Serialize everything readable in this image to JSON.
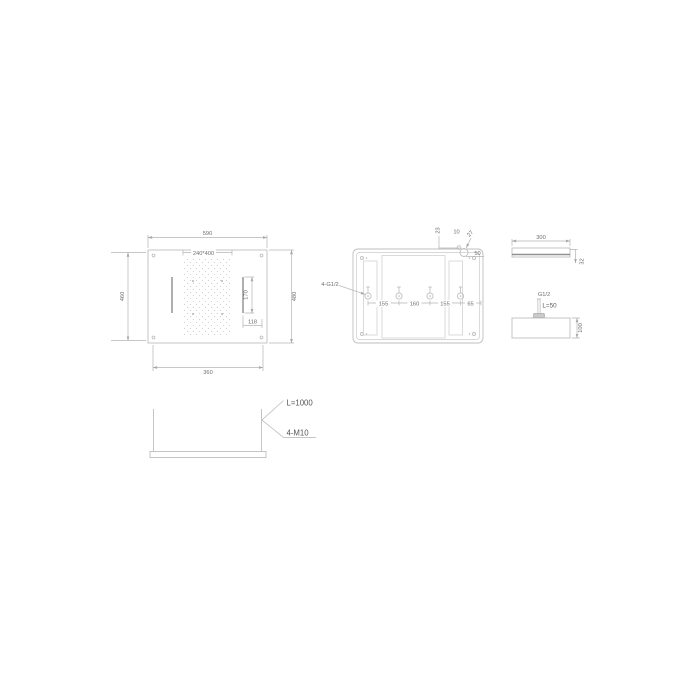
{
  "drawing": {
    "front_view": {
      "width_top": "590",
      "spray_area": "240*400",
      "height_left": "460",
      "height_right": "480",
      "slot_length": "170",
      "slot_offset": "118",
      "width_bottom": "360"
    },
    "back_view": {
      "fittings_label": "4-G1/2",
      "spacings": [
        "155",
        "160",
        "155",
        "65"
      ],
      "inlet_top": "23",
      "inlet_offset": "10",
      "inlet_dia": "27",
      "inlet_corner": "50"
    },
    "side_top": {
      "width": "300",
      "thickness": "32"
    },
    "side_inlet": {
      "thread": "G1/2",
      "stem_length": "L=50",
      "height": "100"
    },
    "bracket": {
      "rod_length": "L=1000",
      "rod_thread": "4-M10"
    }
  },
  "colors": {
    "background": "#ffffff",
    "line": "#bfbfbf",
    "line_dark": "#8f8f8f",
    "text": "#6e6e6e",
    "text_dark": "#555555"
  }
}
